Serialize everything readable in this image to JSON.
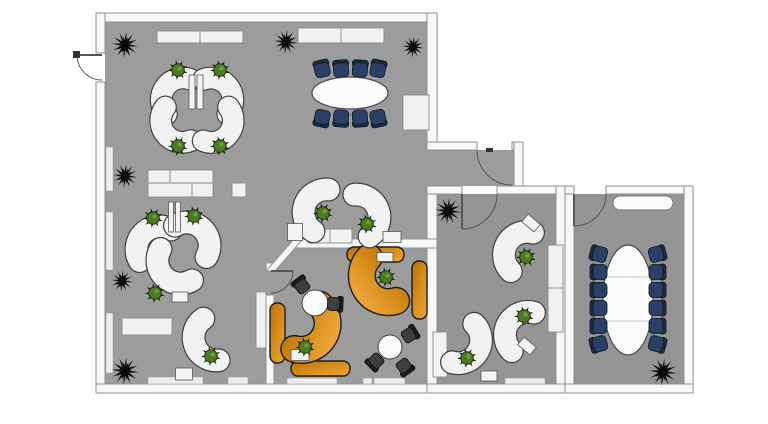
{
  "canvas": {
    "w": 768,
    "h": 424,
    "bg": "#ffffff"
  },
  "palette": {
    "floor_main": "#9c9c9c",
    "floor_right": "#959595",
    "wall_fill": "#f8f8f8",
    "wall_edge": "#909090",
    "desk_white_fill": "#f2f2f2",
    "desk_white_edge": "#3f3f3f",
    "wood_dark": "#b96f0a",
    "wood_light": "#eda43c",
    "wood_edge": "#1c1c1c",
    "navy": "#2c4066",
    "navy_back": "#1b2a45",
    "navy_edge": "#0e1828",
    "chair_black": "#3e3e3e",
    "chair_black_back": "#1d1d1d",
    "chair_black_edge": "#111111",
    "table_fill": "#fbfbfb",
    "table_edge": "#4a4a4a",
    "table_seam": "#c9c9c9",
    "cabinet_fill": "#f1f1f1",
    "cabinet_edge": "#8a8a8a",
    "sill_fill": "#ededed",
    "sill_edge": "#9f9f9f",
    "base_fill": "#f3f3f3",
    "base_edge": "#555555",
    "plant_green": "#4d7a23",
    "plant_green_dark": "#1f3a0c",
    "plant_green_light": "#6fa03e",
    "plant_spike": "#0d0f07",
    "plant_dark": "#0a0a0a",
    "door_arc": "#555555",
    "door_hinge": "#333333"
  },
  "floors": [
    {
      "n": "floor-main-office",
      "x": 105,
      "y": 22,
      "w": 322,
      "h": 362,
      "c": "floor_main"
    },
    {
      "n": "floor-corridor",
      "x": 427,
      "y": 150,
      "w": 87,
      "h": 36,
      "c": "floor_main"
    },
    {
      "n": "floor-office-right",
      "x": 436,
      "y": 194,
      "w": 120,
      "h": 190,
      "c": "floor_right"
    },
    {
      "n": "floor-meeting-right",
      "x": 574,
      "y": 194,
      "w": 110,
      "h": 190,
      "c": "floor_right"
    }
  ],
  "walls": [
    {
      "n": "wall-top",
      "x": 96,
      "y": 13,
      "w": 341,
      "h": 9
    },
    {
      "n": "wall-left-upper",
      "x": 96,
      "y": 13,
      "w": 9,
      "h": 40
    },
    {
      "n": "wall-left-lower",
      "x": 96,
      "y": 82,
      "w": 9,
      "h": 311
    },
    {
      "n": "wall-bottom-main",
      "x": 96,
      "y": 384,
      "w": 341,
      "h": 9
    },
    {
      "n": "wall-right-upper",
      "x": 427,
      "y": 13,
      "w": 10,
      "h": 137
    },
    {
      "n": "wall-corridor-top-left",
      "x": 427,
      "y": 142,
      "w": 50,
      "h": 8
    },
    {
      "n": "wall-corridor-top-right",
      "x": 512,
      "y": 142,
      "w": 11,
      "h": 8
    },
    {
      "n": "wall-corridor-right",
      "x": 514,
      "y": 142,
      "w": 9,
      "h": 52
    },
    {
      "n": "wall-center-divider",
      "x": 427,
      "y": 186,
      "w": 10,
      "h": 198
    },
    {
      "n": "wall-midright-top-left",
      "x": 427,
      "y": 186,
      "w": 35,
      "h": 8
    },
    {
      "n": "wall-midright-top-right",
      "x": 497,
      "y": 186,
      "w": 69,
      "h": 8
    },
    {
      "n": "wall-midright-right",
      "x": 556,
      "y": 186,
      "w": 9,
      "h": 207
    },
    {
      "n": "wall-midright-bottom",
      "x": 427,
      "y": 384,
      "w": 138,
      "h": 9
    },
    {
      "n": "wall-farright-left",
      "x": 565,
      "y": 186,
      "w": 9,
      "h": 207
    },
    {
      "n": "wall-farright-top-stub",
      "x": 565,
      "y": 186,
      "w": 9,
      "h": 8
    },
    {
      "n": "wall-farright-top",
      "x": 606,
      "y": 186,
      "w": 87,
      "h": 8
    },
    {
      "n": "wall-farright-right",
      "x": 684,
      "y": 186,
      "w": 9,
      "h": 207
    },
    {
      "n": "wall-farright-bottom",
      "x": 565,
      "y": 384,
      "w": 128,
      "h": 9
    },
    {
      "n": "wall-orange-room-top",
      "x": 294,
      "y": 239,
      "w": 143,
      "h": 9
    },
    {
      "n": "wall-orange-left-stub",
      "x": 266,
      "y": 263,
      "w": 8,
      "h": 8
    },
    {
      "n": "wall-orange-left",
      "x": 266,
      "y": 295,
      "w": 8,
      "h": 89
    }
  ],
  "wall_polys": [
    {
      "n": "wall-orange-diagonal",
      "pts": "294,239 303,239 275,271 266,271"
    }
  ],
  "doors": [
    {
      "n": "door-entrance-left",
      "leaf": [
        77,
        55,
        102,
        55
      ],
      "arc": "M 77,55 A 25,25 0 0 0 102,80",
      "hinge": [
        73,
        51,
        7,
        7
      ]
    },
    {
      "n": "door-corridor",
      "leaf": null,
      "arc": "M 477,150 A 35,35 0 0 0 512,185",
      "hinge": [
        486,
        148,
        7,
        4
      ]
    },
    {
      "n": "door-office-right",
      "leaf": [
        462,
        194,
        462,
        229
      ],
      "arc": "M 462,229 A 35,35 0 0 0 497,194",
      "hinge": null
    },
    {
      "n": "door-meeting-right",
      "leaf": [
        574,
        194,
        574,
        226
      ],
      "arc": "M 574,226 A 32,32 0 0 0 606,194",
      "hinge": null
    },
    {
      "n": "door-orange-room",
      "leaf": [
        271,
        271,
        293,
        271
      ],
      "arc": "M 293,271 A 22,22 0 0 1 271,293",
      "hinge": null
    }
  ],
  "cabinets": [
    {
      "n": "cabinet-top-1",
      "x": 157,
      "y": 31,
      "w": 86,
      "h": 12,
      "seams": [
        [
          200,
          31,
          200,
          43
        ]
      ]
    },
    {
      "n": "cabinet-top-2",
      "x": 298,
      "y": 28,
      "w": 86,
      "h": 15,
      "seams": [
        [
          341,
          28,
          341,
          43
        ]
      ]
    },
    {
      "n": "cabinet-block",
      "x": 148,
      "y": 170,
      "w": 65,
      "h": 27,
      "seams": [
        [
          148,
          183,
          213,
          183
        ],
        [
          170,
          170,
          170,
          183
        ],
        [
          192,
          183,
          192,
          197
        ]
      ]
    },
    {
      "n": "cabinet-square",
      "x": 232,
      "y": 183,
      "w": 14,
      "h": 14,
      "seams": []
    },
    {
      "n": "cabinet-right-wall",
      "x": 403,
      "y": 95,
      "w": 26,
      "h": 35,
      "seams": []
    },
    {
      "n": "cabinet-mid",
      "x": 308,
      "y": 229,
      "w": 44,
      "h": 14,
      "seams": [
        [
          330,
          229,
          330,
          243
        ]
      ]
    },
    {
      "n": "cabinet-left-mid",
      "x": 122,
      "y": 318,
      "w": 50,
      "h": 17,
      "seams": []
    },
    {
      "n": "cabinet-orange-wall",
      "x": 256,
      "y": 292,
      "w": 10,
      "h": 56,
      "seams": []
    },
    {
      "n": "cabinet-office-right",
      "x": 548,
      "y": 245,
      "w": 15,
      "h": 87,
      "seams": [
        [
          548,
          288,
          563,
          288
        ]
      ]
    },
    {
      "n": "cabinet-office-left",
      "x": 433,
      "y": 332,
      "w": 14,
      "h": 45,
      "seams": []
    }
  ],
  "sills": [
    {
      "n": "sill-left-1",
      "x": 106,
      "y": 147,
      "w": 7,
      "h": 44
    },
    {
      "n": "sill-left-2",
      "x": 106,
      "y": 212,
      "w": 7,
      "h": 58
    },
    {
      "n": "sill-left-3",
      "x": 106,
      "y": 313,
      "w": 7,
      "h": 60
    },
    {
      "n": "sill-bottom-1",
      "x": 148,
      "y": 377,
      "w": 55,
      "h": 7
    },
    {
      "n": "sill-bottom-2",
      "x": 228,
      "y": 377,
      "w": 20,
      "h": 7
    },
    {
      "n": "sill-bottom-3",
      "x": 287,
      "y": 378,
      "w": 50,
      "h": 6
    },
    {
      "n": "sill-bottom-4",
      "x": 363,
      "y": 378,
      "w": 9,
      "h": 6
    },
    {
      "n": "sill-bottom-5",
      "x": 374,
      "y": 378,
      "w": 31,
      "h": 6
    },
    {
      "n": "sill-bottom-6",
      "x": 505,
      "y": 378,
      "w": 40,
      "h": 6
    }
  ],
  "white_desks": [
    {
      "n": "desk-pinwheel-nw",
      "x": 166,
      "y": 88,
      "r": 155,
      "s": 0.95
    },
    {
      "n": "desk-pinwheel-ne",
      "x": 228,
      "y": 88,
      "r": 265,
      "s": 0.95
    },
    {
      "n": "desk-pinwheel-sw",
      "x": 166,
      "y": 133,
      "r": 83,
      "s": 0.95
    },
    {
      "n": "desk-pinwheel-se",
      "x": 228,
      "y": 133,
      "r": -23,
      "s": 0.95
    },
    {
      "n": "desk-pair-left",
      "x": 144,
      "y": 234,
      "r": 165,
      "s": 1
    },
    {
      "n": "desk-pair-right",
      "x": 202,
      "y": 230,
      "r": 255,
      "s": 1
    },
    {
      "n": "desk-mid-single",
      "x": 165,
      "y": 276,
      "r": 75,
      "s": 1
    },
    {
      "n": "desk-bottom-left",
      "x": 196,
      "y": 345,
      "r": 100,
      "s": 1
    },
    {
      "n": "desk-center-a",
      "x": 306,
      "y": 205,
      "r": 140,
      "s": 1
    },
    {
      "n": "desk-center-b",
      "x": 377,
      "y": 210,
      "r": 280,
      "s": 1
    },
    {
      "n": "desk-office-1",
      "x": 508,
      "y": 244,
      "r": 150,
      "s": 1
    },
    {
      "n": "desk-office-2",
      "x": 509,
      "y": 324,
      "r": 150,
      "s": 1
    },
    {
      "n": "desk-office-3",
      "x": 477,
      "y": 351,
      "r": 330,
      "s": 1
    }
  ],
  "orange_arms": [
    {
      "n": "desk-orange-arm-1",
      "x": 367,
      "y": 289,
      "r": 88,
      "s": 1.15
    },
    {
      "n": "desk-orange-arm-2",
      "x": 323,
      "y": 336,
      "r": 330,
      "s": 1.15
    }
  ],
  "orange_bars": [
    {
      "n": "desk-orange-bar-top",
      "x": 347,
      "y": 247,
      "w": 57,
      "h": 15
    },
    {
      "n": "desk-orange-bar-bottom",
      "x": 291,
      "y": 361,
      "w": 59,
      "h": 15
    },
    {
      "n": "sideboard-orange-right",
      "x": 412,
      "y": 261,
      "w": 15,
      "h": 58
    },
    {
      "n": "sideboard-orange-left",
      "x": 270,
      "y": 303,
      "w": 15,
      "h": 60
    }
  ],
  "tables": {
    "conference_oval": {
      "n": "conference-table",
      "x": 350,
      "y": 93,
      "rx": 38,
      "ry": 16
    },
    "meeting_oval": {
      "n": "meeting-table",
      "x": 628,
      "y": 300,
      "rx": 25,
      "ry": 55,
      "seams": [
        277,
        321
      ]
    },
    "rounds": [
      {
        "n": "round-table-1",
        "x": 315,
        "y": 303,
        "r": 13
      },
      {
        "n": "round-table-2",
        "x": 390,
        "y": 347,
        "r": 12
      }
    ],
    "capsule": {
      "n": "sideboard-capsule",
      "x": 613,
      "y": 196,
      "w": 60,
      "h": 14
    }
  },
  "navy_chairs": [
    {
      "x": 322,
      "y": 69,
      "r": -12
    },
    {
      "x": 341,
      "y": 69,
      "r": -4
    },
    {
      "x": 360,
      "y": 69,
      "r": 4
    },
    {
      "x": 378,
      "y": 69,
      "r": 12
    },
    {
      "x": 322,
      "y": 118,
      "r": 192
    },
    {
      "x": 341,
      "y": 118,
      "r": 184
    },
    {
      "x": 360,
      "y": 118,
      "r": 176
    },
    {
      "x": 378,
      "y": 118,
      "r": 168
    },
    {
      "x": 599,
      "y": 254,
      "r": -75
    },
    {
      "x": 599,
      "y": 272,
      "r": -90
    },
    {
      "x": 599,
      "y": 290,
      "r": -90
    },
    {
      "x": 599,
      "y": 308,
      "r": -90
    },
    {
      "x": 599,
      "y": 326,
      "r": -90
    },
    {
      "x": 599,
      "y": 344,
      "r": -105
    },
    {
      "x": 657,
      "y": 254,
      "r": 75
    },
    {
      "x": 657,
      "y": 272,
      "r": 90
    },
    {
      "x": 657,
      "y": 290,
      "r": 90
    },
    {
      "x": 657,
      "y": 308,
      "r": 90
    },
    {
      "x": 657,
      "y": 326,
      "r": 90
    },
    {
      "x": 657,
      "y": 344,
      "r": 105
    }
  ],
  "black_chairs": [
    {
      "x": 302,
      "y": 286,
      "r": -37
    },
    {
      "x": 334,
      "y": 304,
      "r": 93
    },
    {
      "x": 409,
      "y": 335,
      "r": 58
    },
    {
      "x": 404,
      "y": 366,
      "r": 144
    },
    {
      "x": 376,
      "y": 361,
      "r": 225
    }
  ],
  "plants_green": [
    {
      "x": 178,
      "y": 70
    },
    {
      "x": 220,
      "y": 70
    },
    {
      "x": 178,
      "y": 146
    },
    {
      "x": 220,
      "y": 146
    },
    {
      "x": 153,
      "y": 218
    },
    {
      "x": 194,
      "y": 216
    },
    {
      "x": 155,
      "y": 293
    },
    {
      "x": 211,
      "y": 356
    },
    {
      "x": 323,
      "y": 213
    },
    {
      "x": 367,
      "y": 224
    },
    {
      "x": 386,
      "y": 277
    },
    {
      "x": 305,
      "y": 347
    },
    {
      "x": 526,
      "y": 257
    },
    {
      "x": 524,
      "y": 316
    },
    {
      "x": 467,
      "y": 358
    }
  ],
  "plants_dark": [
    {
      "x": 125,
      "y": 45,
      "s": 1.1
    },
    {
      "x": 286,
      "y": 42,
      "s": 1.0
    },
    {
      "x": 413,
      "y": 47,
      "s": 0.9
    },
    {
      "x": 125,
      "y": 176,
      "s": 1.0
    },
    {
      "x": 122,
      "y": 281,
      "s": 0.9
    },
    {
      "x": 125,
      "y": 371,
      "s": 1.15
    },
    {
      "x": 448,
      "y": 211,
      "s": 1.1
    },
    {
      "x": 663,
      "y": 372,
      "s": 1.15
    }
  ],
  "bases": [
    {
      "n": "desk-link",
      "x": 192,
      "y": 92,
      "w": 6,
      "h": 34,
      "r": 0
    },
    {
      "n": "desk-link",
      "x": 200,
      "y": 92,
      "w": 6,
      "h": 34,
      "r": 0
    },
    {
      "n": "desk-link",
      "x": 171,
      "y": 217,
      "w": 5,
      "h": 30,
      "r": 0
    },
    {
      "n": "desk-link",
      "x": 178,
      "y": 217,
      "w": 5,
      "h": 30,
      "r": 0
    },
    {
      "n": "desk-base",
      "x": 180,
      "y": 297,
      "w": 16,
      "h": 10,
      "r": 0
    },
    {
      "n": "desk-base",
      "x": 184,
      "y": 374,
      "w": 17,
      "h": 12,
      "r": 0
    },
    {
      "n": "desk-base",
      "x": 295,
      "y": 232,
      "w": 15,
      "h": 17,
      "r": 0
    },
    {
      "n": "desk-base",
      "x": 392,
      "y": 237,
      "w": 18,
      "h": 11,
      "r": 0
    },
    {
      "n": "desk-base",
      "x": 531,
      "y": 223,
      "w": 16,
      "h": 10,
      "r": 40
    },
    {
      "n": "desk-base",
      "x": 527,
      "y": 346,
      "w": 16,
      "h": 10,
      "r": 40
    },
    {
      "n": "desk-base",
      "x": 489,
      "y": 376,
      "w": 16,
      "h": 10,
      "r": 0
    },
    {
      "n": "desk-base",
      "x": 385,
      "y": 257,
      "w": 16,
      "h": 9,
      "r": 0
    },
    {
      "n": "desk-base",
      "x": 300,
      "y": 355,
      "w": 18,
      "h": 11,
      "r": 0
    }
  ]
}
